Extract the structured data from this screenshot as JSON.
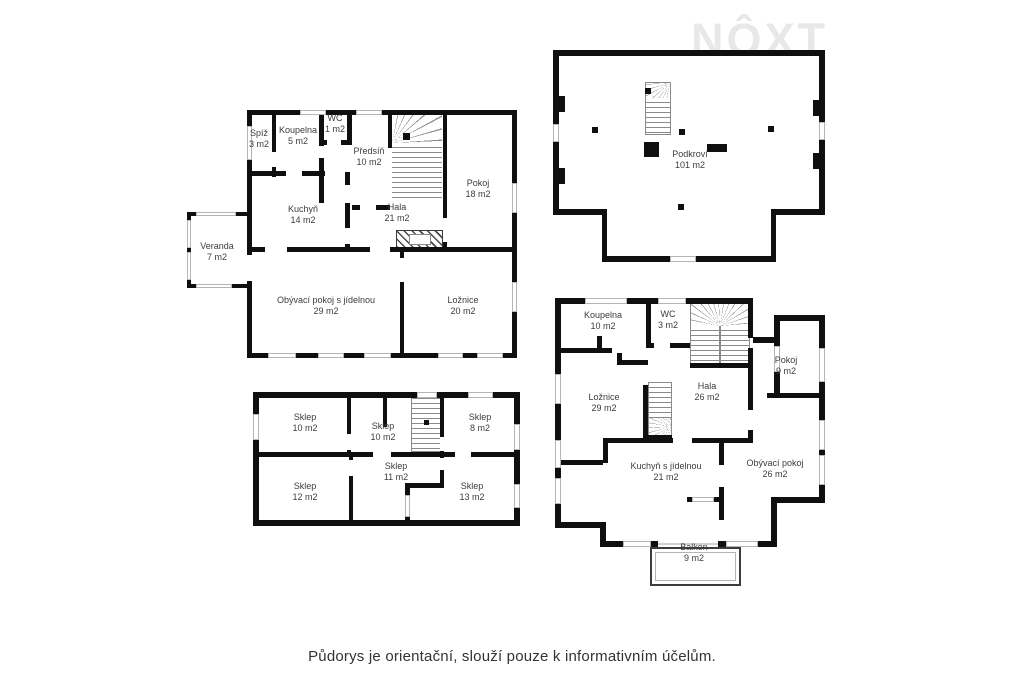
{
  "logo": {
    "text": "NÔXT"
  },
  "caption": "Půdorys je orientační, slouží pouze k informativním účelům.",
  "colors": {
    "wall": "#0f0f0f",
    "window_frame": "#b5b5b5",
    "label_text": "#3c3c3c",
    "logo_gray": "#e8e8e8",
    "stair_line": "#8a8a8a",
    "background": "#ffffff"
  },
  "plans": [
    {
      "id": "ground-floor",
      "rooms": [
        {
          "name": "Spíž",
          "area": "3 m2"
        },
        {
          "name": "Koupelna",
          "area": "5 m2"
        },
        {
          "name": "WC",
          "area": "1 m2"
        },
        {
          "name": "Předsíň",
          "area": "10 m2"
        },
        {
          "name": "Kuchyň",
          "area": "14 m2"
        },
        {
          "name": "Hala",
          "area": "21 m2"
        },
        {
          "name": "Pokoj",
          "area": "18 m2"
        },
        {
          "name": "Veranda",
          "area": "7 m2"
        },
        {
          "name": "Obývací pokoj s jídelnou",
          "area": "29 m2"
        },
        {
          "name": "Ložnice",
          "area": "20 m2"
        }
      ]
    },
    {
      "id": "attic",
      "rooms": [
        {
          "name": "Podkroví",
          "area": "101 m2"
        }
      ]
    },
    {
      "id": "basement",
      "rooms": [
        {
          "name": "Sklep",
          "area": "10 m2"
        },
        {
          "name": "Sklep",
          "area": "10 m2"
        },
        {
          "name": "Sklep",
          "area": "8 m2"
        },
        {
          "name": "Sklep",
          "area": "12 m2"
        },
        {
          "name": "Sklep",
          "area": "11 m2"
        },
        {
          "name": "Sklep",
          "area": "13 m2"
        }
      ]
    },
    {
      "id": "upper-floor",
      "rooms": [
        {
          "name": "Koupelna",
          "area": "10 m2"
        },
        {
          "name": "WC",
          "area": "3 m2"
        },
        {
          "name": "Pokoj",
          "area": "9 m2"
        },
        {
          "name": "Ložnice",
          "area": "29 m2"
        },
        {
          "name": "Hala",
          "area": "26 m2"
        },
        {
          "name": "Kuchyň s jídelnou",
          "area": "21 m2"
        },
        {
          "name": "Obývací pokoj",
          "area": "26 m2"
        },
        {
          "name": "Balkon",
          "area": "9 m2"
        }
      ]
    }
  ]
}
